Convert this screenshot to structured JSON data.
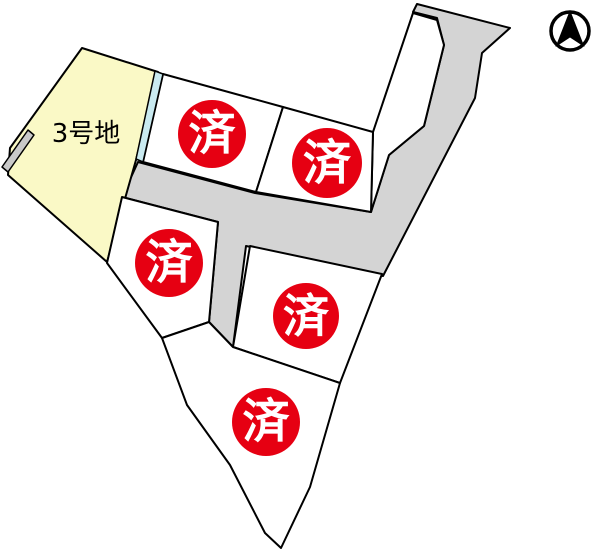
{
  "map": {
    "title": "subdivision-plot-map",
    "canvas": {
      "width": 600,
      "height": 552
    },
    "colors": {
      "background": "#ffffff",
      "outline": "#000000",
      "lot_available_fill": "#faf9c6",
      "lot_sold_fill": "#ffffff",
      "road_fill": "#d4d4d4",
      "water_strip_fill": "#c9eaf0",
      "wall_strip_fill": "#c9c9c9",
      "badge_fill": "#e60012",
      "badge_text_color": "#ffffff",
      "label_text_color": "#000000"
    },
    "stroke_width": 2,
    "badge_label": "済",
    "roads": [
      {
        "id": "road-network",
        "points": "138,162 255,193 371,212 389,155 424,126 444,45 437,18 413,12 417,4 510,28 482,53 475,98 383,276 251,247 246,246 233,347 209,322 218,222 122,197"
      }
    ],
    "reserve_areas": [
      {
        "id": "road-reserve-wedge",
        "points": "413,13 437,20 444,45 424,126 389,155 371,212 373,132"
      }
    ],
    "lots": [
      {
        "id": "lot-3",
        "label": "3号地",
        "status": "available",
        "points": "82,48 158,72 136,160 107,262 8,175 10,148",
        "label_x": 86,
        "label_y": 142,
        "label_size": 26
      },
      {
        "id": "lot-sold-1",
        "status": "sold",
        "points": "163,74 283,107 256,192 143,162",
        "badge": {
          "cx": 212,
          "cy": 134,
          "r": 34
        }
      },
      {
        "id": "lot-sold-2",
        "status": "sold",
        "points": "283,107 373,132 371,212 256,192",
        "badge": {
          "cx": 327,
          "cy": 163,
          "r": 35
        }
      },
      {
        "id": "lot-sold-3",
        "status": "sold",
        "points": "122,197 218,222 209,322 162,338 107,263",
        "badge": {
          "cx": 169,
          "cy": 263,
          "r": 34
        }
      },
      {
        "id": "lot-sold-4",
        "status": "sold",
        "points": "250,246 382,274 340,383 233,347",
        "badge": {
          "cx": 306,
          "cy": 316,
          "r": 33
        }
      },
      {
        "id": "lot-sold-5",
        "status": "sold",
        "points": "162,338 209,322 233,347 340,383 310,487 281,548 265,533 230,465 187,405",
        "badge": {
          "cx": 266,
          "cy": 422,
          "r": 34
        }
      }
    ],
    "strips": [
      {
        "id": "water-strip",
        "fill_key": "water_strip_fill",
        "points": "155,71 163,74 143,162 136,159"
      },
      {
        "id": "wall-strip",
        "fill_key": "wall_strip_fill",
        "points": "28,130 34,135 8,172 2,167"
      }
    ],
    "north_arrow": {
      "cx": 570,
      "cy": 31,
      "ring_r": 19,
      "ring_stroke": 3.5
    }
  }
}
